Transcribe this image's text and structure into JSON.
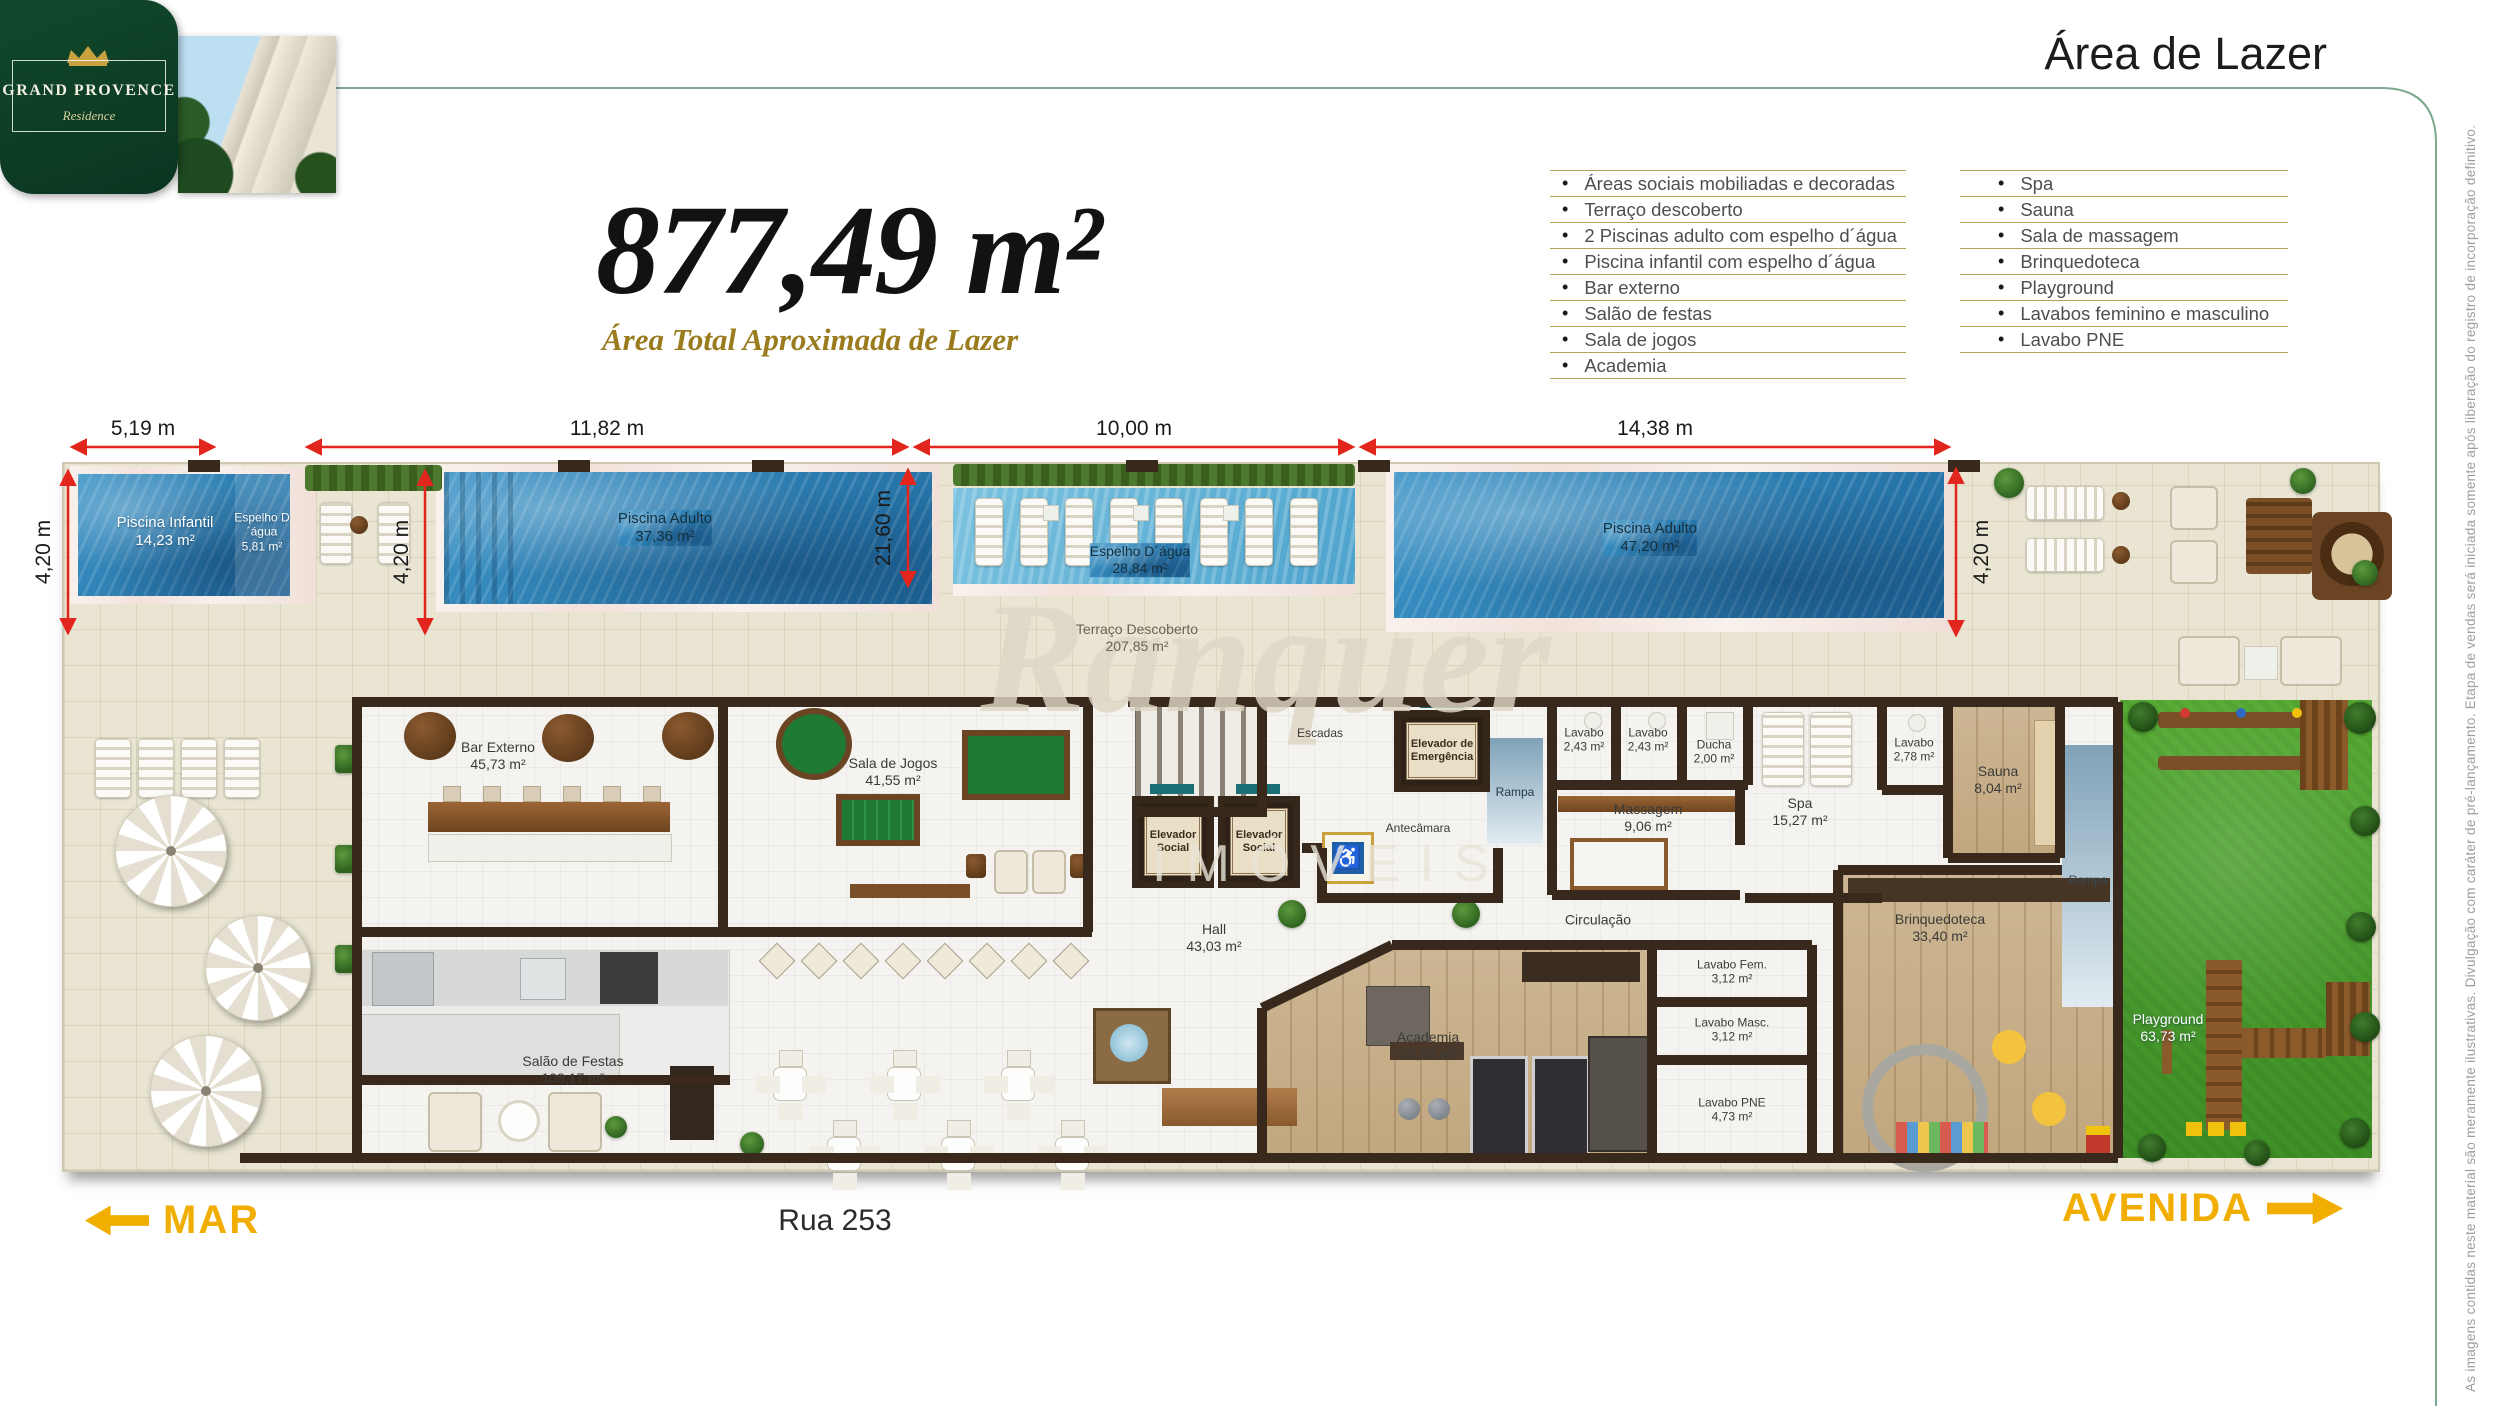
{
  "brand": {
    "name": "GRAND PROVENCE",
    "subname": "Residence"
  },
  "page_title": "Área de Lazer",
  "total_area": {
    "value": "877,49 m²",
    "label": "Área Total Aproximada de Lazer"
  },
  "features_left": {
    "items": [
      "Áreas sociais mobiliadas e decoradas",
      "Terraço descoberto",
      "2 Piscinas adulto com espelho d´água",
      "Piscina infantil com espelho d´água",
      "Bar externo",
      "Salão de festas",
      "Sala de jogos",
      "Academia"
    ]
  },
  "features_right": {
    "items": [
      "Spa",
      "Sauna",
      "Sala de massagem",
      "Brinquedoteca",
      "Playground",
      "Lavabos feminino e masculino",
      "Lavabo PNE"
    ]
  },
  "dimensions": {
    "d1": "5,19 m",
    "d2": "11,82 m",
    "d3": "10,00 m",
    "d4": "14,38 m",
    "v1": "4,20 m",
    "v2": "4,20 m",
    "v3": "21,60 m",
    "v4": "4,20 m"
  },
  "rooms": {
    "piscina_infantil": {
      "name": "Piscina Infantil",
      "area": "14,23 m²"
    },
    "espelho_1": {
      "name": "Espelho D´água",
      "area": "5,81 m²"
    },
    "piscina_adulto_1": {
      "name": "Piscina Adulto",
      "area": "37,36 m²"
    },
    "espelho_2": {
      "name": "Espelho D´água",
      "area": "28,84 m²"
    },
    "terraco": {
      "name": "Terraço Descoberto",
      "area": "207,85 m²"
    },
    "piscina_adulto_2": {
      "name": "Piscina Adulto",
      "area": "47,20 m²"
    },
    "bar_externo": {
      "name": "Bar Externo",
      "area": "45,73 m²"
    },
    "sala_jogos": {
      "name": "Sala de Jogos",
      "area": "41,55 m²"
    },
    "escadas": {
      "name": "Escadas"
    },
    "elevador_social": {
      "name": "Elevador Social"
    },
    "elevador_emergencia": {
      "name": "Elevador de Emergência"
    },
    "antecamara": {
      "name": "Antecâmara"
    },
    "rampa": {
      "name": "Rampa"
    },
    "lavabo_a": {
      "name": "Lavabo",
      "area": "2,43 m²"
    },
    "lavabo_b": {
      "name": "Lavabo",
      "area": "2,43 m²"
    },
    "ducha": {
      "name": "Ducha",
      "area": "2,00 m²"
    },
    "massagem": {
      "name": "Massagem",
      "area": "9,06 m²"
    },
    "spa": {
      "name": "Spa",
      "area": "15,27 m²"
    },
    "lavabo_c": {
      "name": "Lavabo",
      "area": "2,78 m²"
    },
    "sauna": {
      "name": "Sauna",
      "area": "8,04 m²"
    },
    "hall": {
      "name": "Hall",
      "area": "43,03 m²"
    },
    "circulacao": {
      "name": "Circulação"
    },
    "brinquedoteca": {
      "name": "Brinquedoteca",
      "area": "33,40 m²"
    },
    "salao_festas": {
      "name": "Salão de Festas",
      "area": "108,17 m²"
    },
    "academia": {
      "name": "Academia",
      "area": "36,68 m²"
    },
    "lavabo_fem": {
      "name": "Lavabo Fem.",
      "area": "3,12 m²"
    },
    "lavabo_masc": {
      "name": "Lavabo Masc.",
      "area": "3,12 m²"
    },
    "lavabo_pne": {
      "name": "Lavabo PNE",
      "area": "4,73 m²"
    },
    "playground": {
      "name": "Playground",
      "area": "63,73 m²"
    }
  },
  "footer": {
    "left": "MAR",
    "street": "Rua 253",
    "right": "AVENIDA"
  },
  "watermark": {
    "line1": "Ranquer",
    "line2": "IMÓVEIS"
  },
  "disclaimer": "As imagens contidas neste material são meramente ilustrativas. Divulgação com caráter de pré-lançamento. Etapa de vendas será iniciada somente após liberação do registro de incorporação definitivo."
}
